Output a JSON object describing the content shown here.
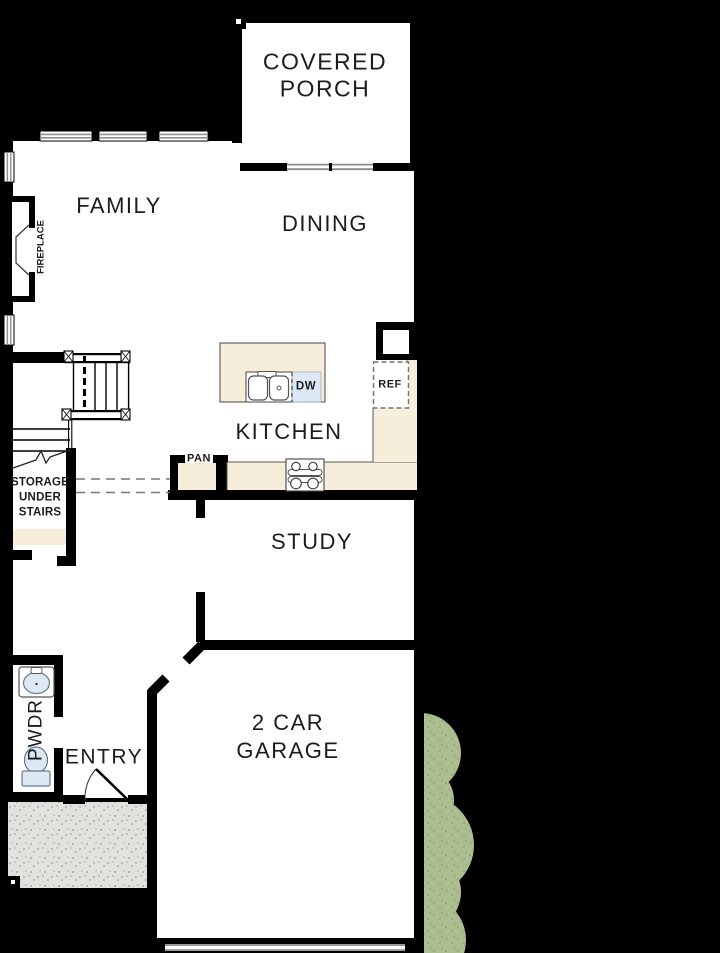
{
  "labels": {
    "covered_porch_line1": "COVERED",
    "covered_porch_line2": "PORCH",
    "family": "FAMILY",
    "dining": "DINING",
    "kitchen": "KITCHEN",
    "study": "STUDY",
    "garage_line1": "2 CAR",
    "garage_line2": "GARAGE",
    "entry": "ENTRY",
    "pwdr": "PWDR",
    "fireplace": "FIREPLACE",
    "storage_line1": "STORAGE",
    "storage_line2": "UNDER",
    "storage_line3": "STAIRS",
    "pan": "PAN",
    "dw": "DW",
    "ref": "REF"
  },
  "colors": {
    "background": "#000000",
    "wall": "#000000",
    "floor": "#ffffff",
    "counter": "#F6EEDA",
    "fixture_blue": "#DCE9F4",
    "bush_green": "#ACBE8F",
    "porch_concrete": "#E1E1DD",
    "glass_gray": "#8F8F8F"
  }
}
